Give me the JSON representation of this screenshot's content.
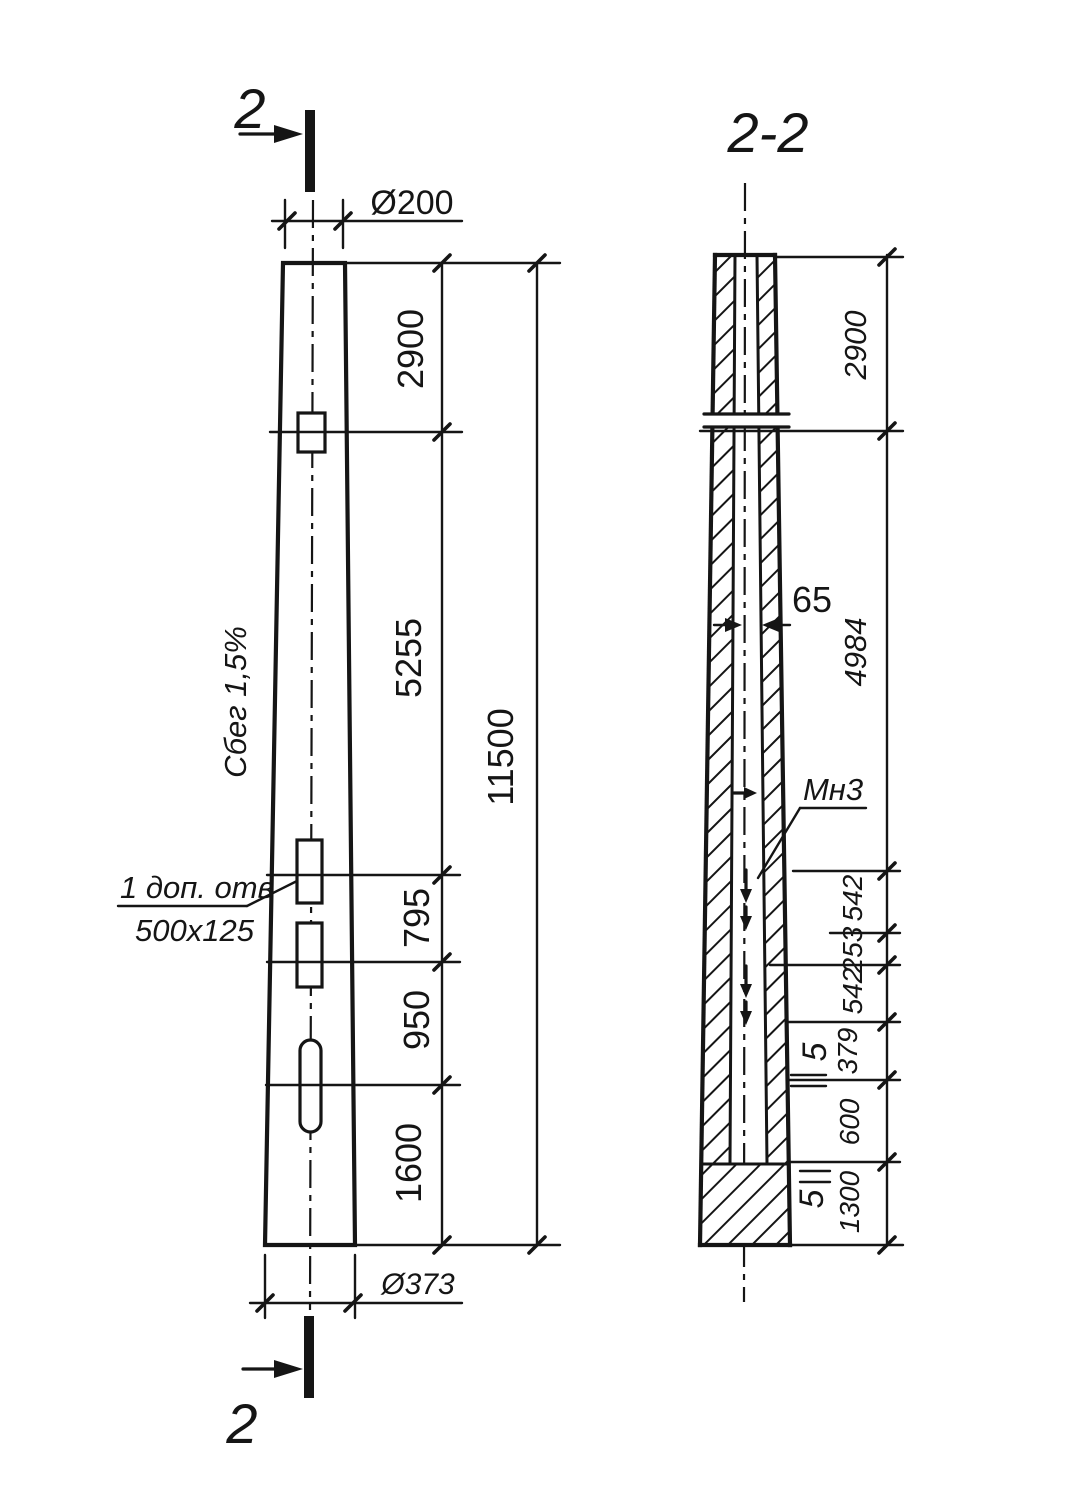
{
  "ink_color": "#151515",
  "paper_color": "#ffffff",
  "section_marks": {
    "top": "2",
    "bottom": "2"
  },
  "left_view": {
    "taper_label": "Сбег 1,5%",
    "top_diameter": "Ø200",
    "bottom_diameter": "Ø373",
    "hole_note_line1": "1 доп. отв",
    "hole_note_line2": "500x125",
    "chain_dims": [
      "2900",
      "5255",
      "795",
      "950",
      "1600"
    ],
    "overall_dim": "11500"
  },
  "section_view": {
    "title": "2-2",
    "core_dim": "65",
    "mark_label": "Мн3",
    "chain_dims": [
      "2900",
      "4984",
      "542",
      "253",
      "542",
      "379",
      "600",
      "1300"
    ],
    "gap_dims": [
      "5",
      "5"
    ]
  }
}
